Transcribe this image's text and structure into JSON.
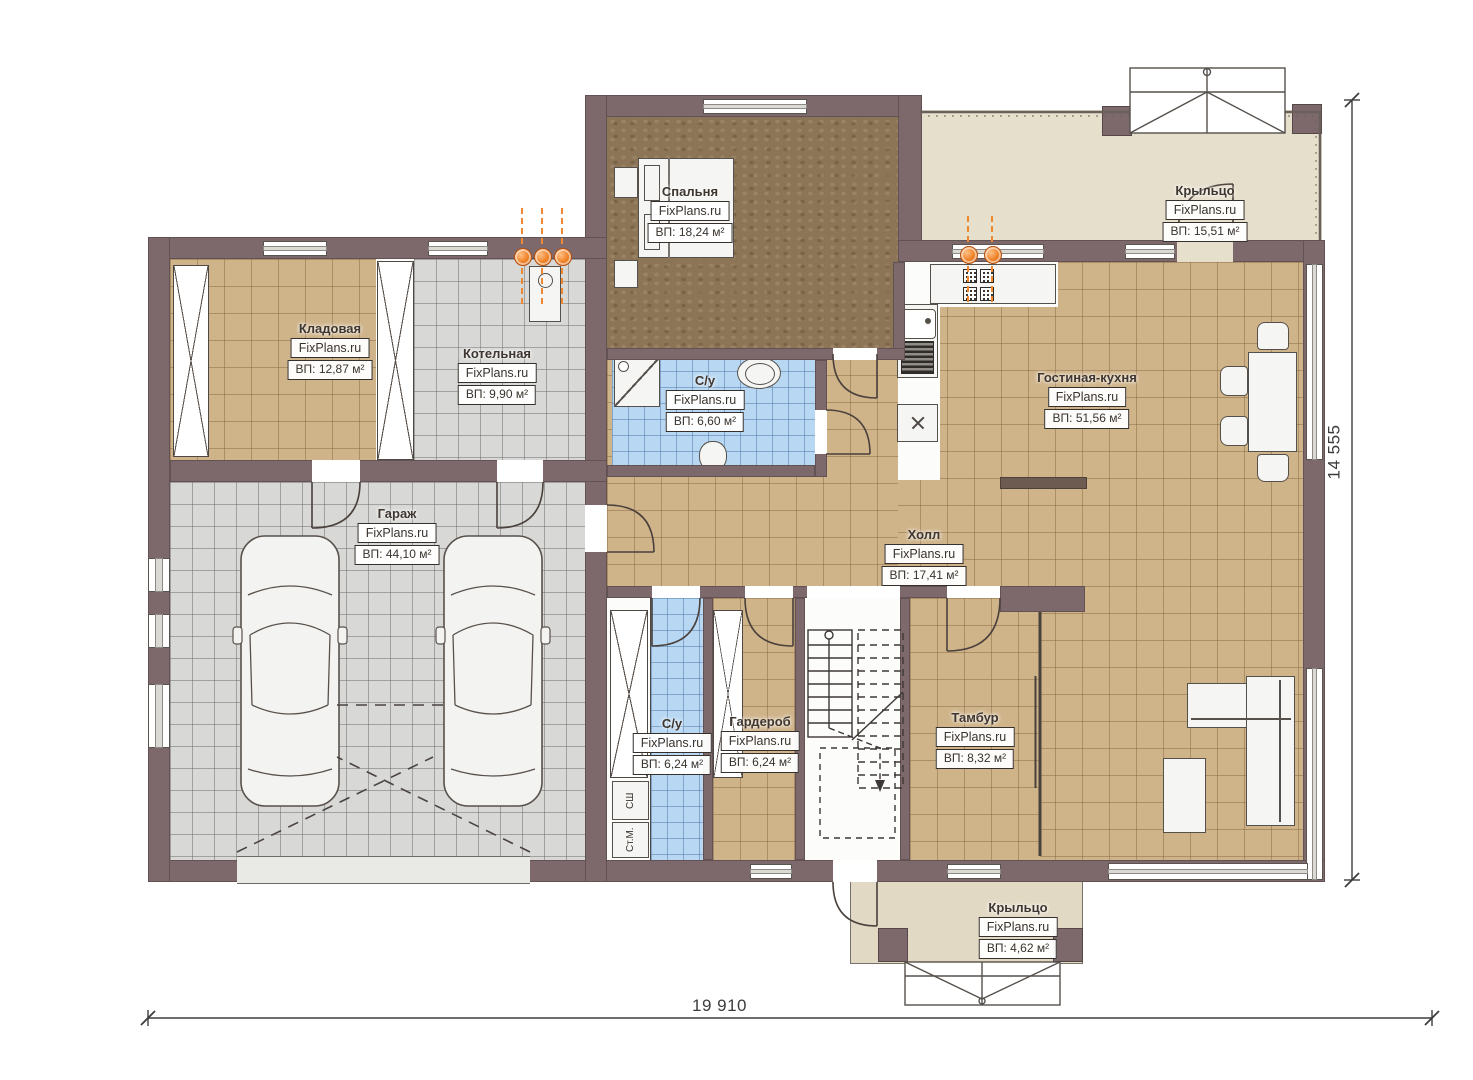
{
  "plan": {
    "brand": "FixPlans.ru",
    "rooms": [
      {
        "name": "Спальня",
        "area": "ВП: 18,24 м²"
      },
      {
        "name": "Крыльцо",
        "area": "ВП: 15,51 м²"
      },
      {
        "name": "Кладовая",
        "area": "ВП: 12,87 м²"
      },
      {
        "name": "Котельная",
        "area": "ВП: 9,90 м²"
      },
      {
        "name": "С/у",
        "area": "ВП: 6,60 м²"
      },
      {
        "name": "Гостиная-кухня",
        "area": "ВП: 51,56 м²"
      },
      {
        "name": "Гараж",
        "area": "ВП: 44,10 м²"
      },
      {
        "name": "Холл",
        "area": "ВП: 17,41 м²"
      },
      {
        "name": "С/у",
        "area": "ВП: 6,24 м²"
      },
      {
        "name": "Гардероб",
        "area": "ВП: 6,24 м²"
      },
      {
        "name": "Тамбур",
        "area": "ВП: 8,32 м²"
      },
      {
        "name": "Крыльцо",
        "area": "ВП: 4,62 м²"
      }
    ],
    "appliances": {
      "dryer_cabinet": "СШ",
      "washing_machine": "Ст.М."
    },
    "dimensions": {
      "overall_width": "19 910",
      "overall_height": "14 555"
    },
    "colors": {
      "wall": "#7d696b",
      "tile_tan": "#cfb389",
      "tile_gray": "#d8d8d6",
      "tile_blue": "#b7d7f2",
      "bedroom_floor": "#8c7456",
      "porch_floor": "#e6dfcc",
      "gas_orange": "#ef7d1e"
    }
  }
}
